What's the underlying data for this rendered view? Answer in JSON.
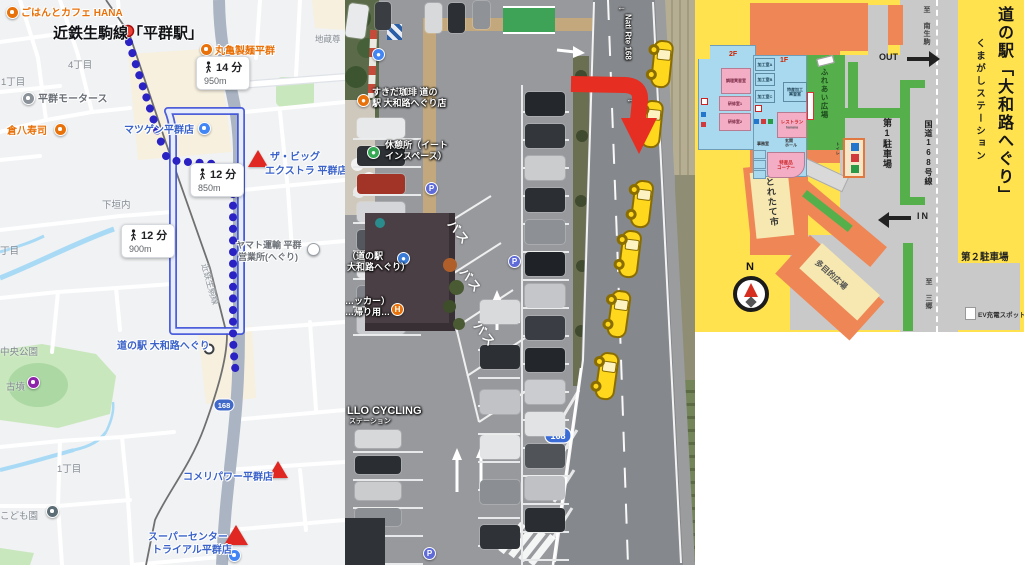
{
  "left_map": {
    "title": "近鉄生駒線「平群駅」",
    "railway_label": "近鉄生駒線",
    "route_shield": "168",
    "badges": [
      {
        "time": "14 分",
        "dist": "950m"
      },
      {
        "time": "12 分",
        "dist": "850m"
      },
      {
        "time": "12 分",
        "dist": "900m"
      }
    ],
    "pois": {
      "hana": "ごはんとカフェ HANA",
      "jizoson": "地蔵尊",
      "marugame": "丸亀製麺平群",
      "chome4": "4丁目",
      "chome1a": "1丁目",
      "motors": "平群モータース",
      "kurahachi": "倉八寿司",
      "matsugen": "マツゲン平群店",
      "bigextra1": "ザ・ビッグ",
      "bigextra2": "エクストラ 平群店",
      "shimogaito": "下垣内",
      "yamato1": "ヤマト運輸 平群",
      "yamato2": "営業所(へぐり)",
      "chome_part": "丁目",
      "michinoeki": "道の駅 大和路へぐり",
      "park": "中央公園",
      "kofun": "古墳",
      "chome1b": "1丁目",
      "kodomoen": "こども園",
      "komeri": "コメリパワー平群店",
      "trial1": "スーパーセンター",
      "trial2": "トライアル平群店"
    }
  },
  "satellite": {
    "road_name": "Natl Rte 168",
    "natl_arrow": "←",
    "route_shield": "168",
    "bus_label": "バス",
    "parking_letter": "P",
    "labels": {
      "coffee1": "すきだ珈琲 道の",
      "coffee2": "駅 大和路へぐり店",
      "rest1": "休憩所（イート",
      "rest2": "インスペース）",
      "station1": "（道の駅",
      "station2": "大和路へぐり）",
      "takeout1": "…ッカー）",
      "takeout2": "…帰り用…",
      "cycling1": "LLO CYCLING",
      "cycling2": "ステーション"
    }
  },
  "facility_map": {
    "title": "道の駅「大和路へぐり」",
    "subtitle": "くまがしステーション",
    "to_north": "至 南生駒",
    "to_south": "至 三郷",
    "out": "OUT",
    "in": "IN",
    "route_label": "国道168号線",
    "parking1": "第1駐車場",
    "parking2": "第２駐車場",
    "ev": "EV充電スポット",
    "plaza_multi": "多目的広場",
    "market": "とれたて市",
    "plaza_fureai": "ふれあい広場",
    "restaurant": "レストラン",
    "restaurant_en": "hanana",
    "corner1": "特産品",
    "corner2": "コーナー",
    "office": "事務室",
    "hall1": "玄関",
    "hall2": "ホール",
    "f2": "2F",
    "f1": "1F",
    "cooking": "調理実習室",
    "training1": "研修室1",
    "training2": "研修室2",
    "kako_a": "加工室A",
    "kako_b": "加工室B",
    "kako_c": "加工室C",
    "tokusankako1": "特産加工",
    "tokusankako2": "実習室",
    "toilet": "トイレ",
    "north": "N"
  }
}
